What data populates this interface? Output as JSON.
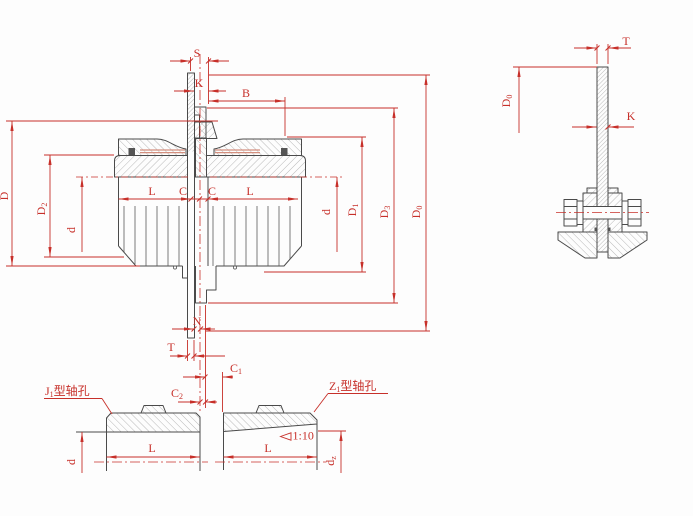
{
  "main_view": {
    "dim_s": "S",
    "dim_k": "K",
    "dim_b": "B",
    "dim_d_outer": "D",
    "dim_d2": {
      "base": "D",
      "sub": "2"
    },
    "dim_bore_left": "d",
    "dim_bore_right": "d",
    "dim_len_left": "L",
    "dim_gap_left": "C",
    "dim_gap_right": "C",
    "dim_len_right": "L",
    "dim_d1": {
      "base": "D",
      "sub": "1"
    },
    "dim_d3": {
      "base": "D",
      "sub": "3"
    },
    "dim_d0": {
      "base": "D",
      "sub": "0"
    },
    "dim_n": "N",
    "dim_t": "T",
    "dim_c1": {
      "base": "C",
      "sub": "1"
    },
    "dim_c2": {
      "base": "C",
      "sub": "2"
    }
  },
  "detail_view": {
    "dim_t": "T",
    "dim_d0": {
      "base": "D",
      "sub": "0"
    },
    "dim_k": "K"
  },
  "j1_view": {
    "title_base": "J",
    "title_sub": "1",
    "title_rest": "型轴孔",
    "dim_len": "L",
    "dim_bore": "d"
  },
  "z1_view": {
    "title_base": "Z",
    "title_sub": "1",
    "title_rest": "型轴孔",
    "dim_len": "L",
    "dim_bore_base": "d",
    "dim_bore_sub": "z",
    "taper": "1:10"
  },
  "colors": {
    "dimension_red": "#c7302a",
    "outline": "#4a4a4a",
    "hatch": "#9a9a9a",
    "background": "#fdfdfd"
  }
}
